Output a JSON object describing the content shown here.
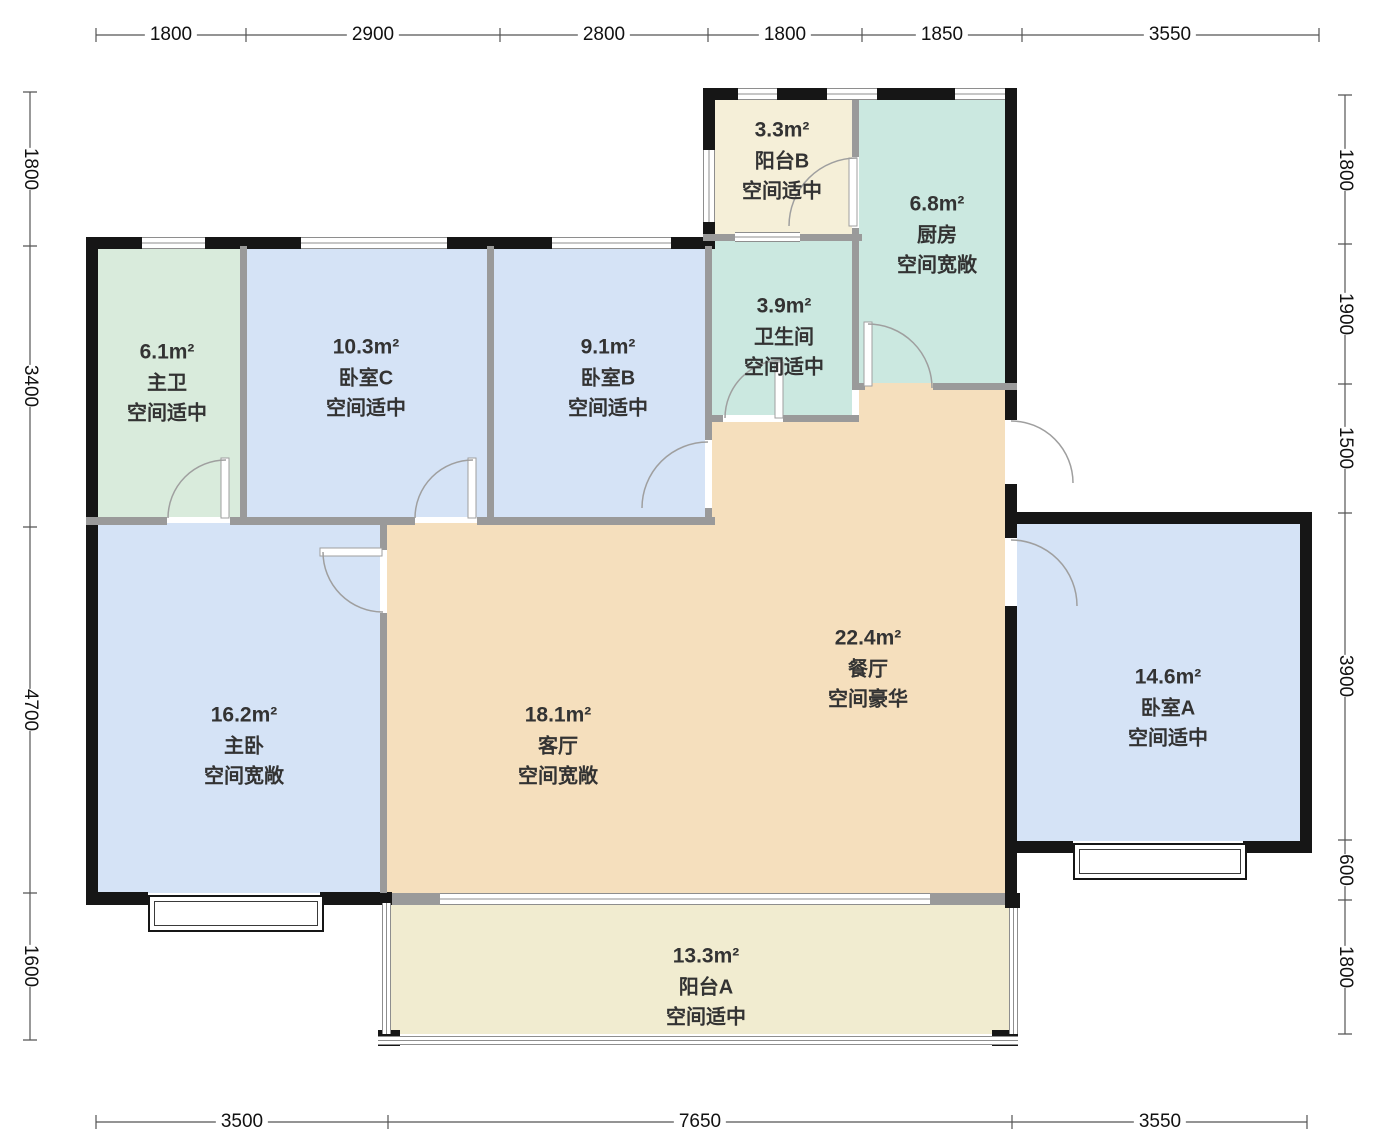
{
  "title": "apartment-floor-plan",
  "colors": {
    "exterior_wall": "#161616",
    "interior_wall": "#9a9a9a",
    "dimension_line": "#555555",
    "label_text": "#333333",
    "bedroom_fill": "#d5e3f6",
    "bath_fill": "#cbe8e0",
    "living_fill": "#f5dfbd",
    "balcony_fill": "#f1ecd0"
  },
  "rooms": [
    {
      "id": "master-bath",
      "area": "6.1m²",
      "name": "主卫",
      "desc": "空间适中",
      "color": "#d9ebdc"
    },
    {
      "id": "bedroom-c",
      "area": "10.3m²",
      "name": "卧室C",
      "desc": "空间适中",
      "color": "#d5e3f6"
    },
    {
      "id": "bedroom-b",
      "area": "9.1m²",
      "name": "卧室B",
      "desc": "空间适中",
      "color": "#d5e3f6"
    },
    {
      "id": "balcony-b",
      "area": "3.3m²",
      "name": "阳台B",
      "desc": "空间适中",
      "color": "#f5efd8"
    },
    {
      "id": "bathroom",
      "area": "3.9m²",
      "name": "卫生间",
      "desc": "空间适中",
      "color": "#cbe8e0"
    },
    {
      "id": "kitchen",
      "area": "6.8m²",
      "name": "厨房",
      "desc": "空间宽敞",
      "color": "#cbe8e0"
    },
    {
      "id": "dining-room",
      "area": "22.4m²",
      "name": "餐厅",
      "desc": "空间豪华",
      "color": "#f5dfbd"
    },
    {
      "id": "living-room",
      "area": "18.1m²",
      "name": "客厅",
      "desc": "空间宽敞",
      "color": "#f5dfbd"
    },
    {
      "id": "master-bedroom",
      "area": "16.2m²",
      "name": "主卧",
      "desc": "空间宽敞",
      "color": "#d5e3f6"
    },
    {
      "id": "bedroom-a",
      "area": "14.6m²",
      "name": "卧室A",
      "desc": "空间适中",
      "color": "#d5e3f6"
    },
    {
      "id": "balcony-a",
      "area": "13.3m²",
      "name": "阳台A",
      "desc": "空间适中",
      "color": "#f1ecd0"
    }
  ],
  "dimensions": {
    "top": [
      "1800",
      "2900",
      "2800",
      "1800",
      "1850",
      "3550"
    ],
    "left": [
      "1800",
      "3400",
      "4700",
      "1600"
    ],
    "right": [
      "1800",
      "1900",
      "1500",
      "3900",
      "600",
      "1800"
    ],
    "bottom": [
      "3500",
      "7650",
      "3550"
    ]
  }
}
